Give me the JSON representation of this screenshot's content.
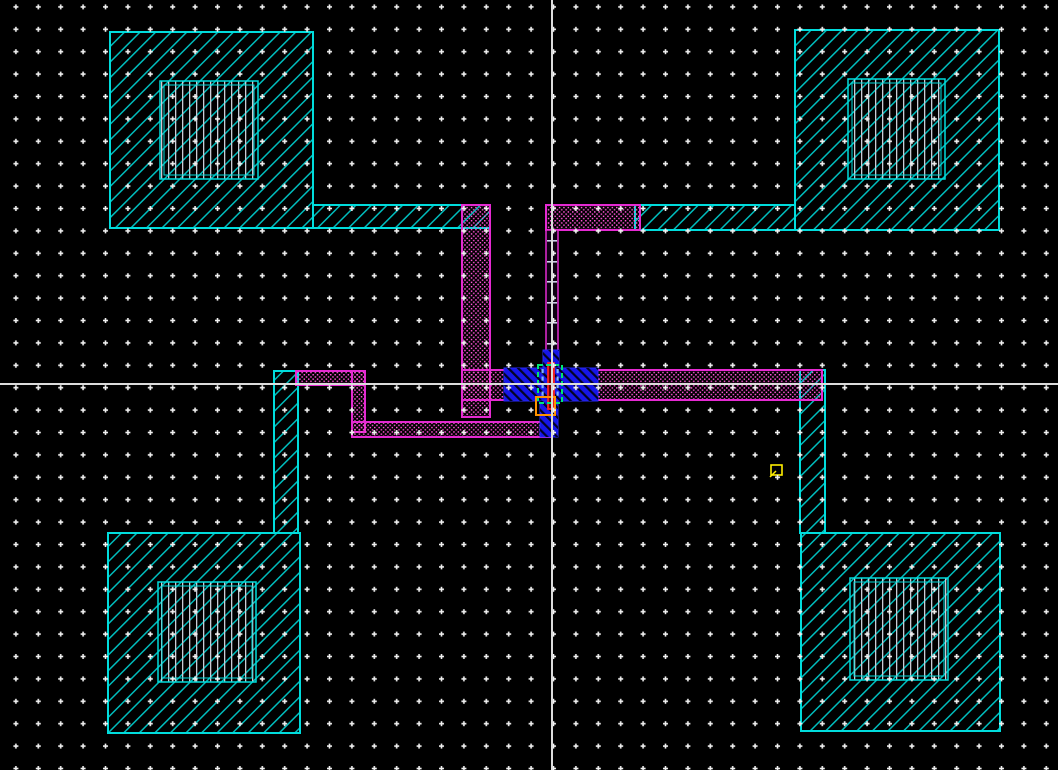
{
  "canvas": {
    "width": 1058,
    "height": 770,
    "background": "#000000"
  },
  "grid": {
    "spacing": 22.4,
    "offset_x": 16,
    "offset_y": 7,
    "dot_style": "plus",
    "dot_color": "#f2f2f2"
  },
  "crosshair": {
    "x": 551,
    "y": 383,
    "color": "#dcdcdc"
  },
  "palette": {
    "pad_cyan": "#00dcdc",
    "metal_magenta": "#e52ad2",
    "metal_stipple_pink": "#ff54d8",
    "device_blue": "#1616e8",
    "gate_red": "#ff2222",
    "select_green": "#00e673",
    "marker_orange": "#ff9100",
    "instance_yellow": "#ffee00",
    "opening_gray": "#c9ccd6"
  },
  "shapes": [
    {
      "type": "rect",
      "name": "canvas-background",
      "x": 0,
      "y": 0,
      "w": 1058,
      "h": 770,
      "fill": "#000000"
    },
    {
      "type": "rect",
      "name": "pad-top-left",
      "x": 110,
      "y": 32,
      "w": 203,
      "h": 196,
      "fill": "p:hatchCyan",
      "stroke": "#00dcdc",
      "sw": 2
    },
    {
      "type": "rect",
      "name": "pad-top-left-arm",
      "x": 313,
      "y": 205,
      "w": 177,
      "h": 23,
      "fill": "p:hatchCyan",
      "stroke": "#00dcdc",
      "sw": 2
    },
    {
      "type": "rect",
      "name": "pad-top-right",
      "x": 795,
      "y": 30,
      "w": 204,
      "h": 200,
      "fill": "p:hatchCyan",
      "stroke": "#00dcdc",
      "sw": 2
    },
    {
      "type": "rect",
      "name": "pad-top-right-arm",
      "x": 635,
      "y": 205,
      "w": 160,
      "h": 25,
      "fill": "p:hatchCyan",
      "stroke": "#00dcdc",
      "sw": 2
    },
    {
      "type": "rect",
      "name": "pad-bottom-left",
      "x": 108,
      "y": 533,
      "w": 192,
      "h": 200,
      "fill": "p:hatchCyan",
      "stroke": "#00dcdc",
      "sw": 2
    },
    {
      "type": "rect",
      "name": "pad-bottom-left-arm",
      "x": 274,
      "y": 371,
      "w": 24,
      "h": 162,
      "fill": "p:hatchCyan",
      "stroke": "#00dcdc",
      "sw": 2
    },
    {
      "type": "rect",
      "name": "pad-bottom-right",
      "x": 801,
      "y": 533,
      "w": 199,
      "h": 198,
      "fill": "p:hatchCyan",
      "stroke": "#00dcdc",
      "sw": 2
    },
    {
      "type": "rect",
      "name": "pad-bottom-right-arm",
      "x": 800,
      "y": 370,
      "w": 25,
      "h": 163,
      "fill": "p:hatchCyan",
      "stroke": "#00dcdc",
      "sw": 2
    },
    {
      "type": "rect",
      "name": "pad-opening-top-left",
      "x": 160,
      "y": 81,
      "w": 98,
      "h": 98,
      "fill": "p:vertLines",
      "stroke": "#00dcdc",
      "sw": 1.5
    },
    {
      "type": "rect",
      "name": "pad-opening-top-left-inner",
      "x": 164,
      "y": 85,
      "w": 90,
      "h": 90,
      "fill": "none",
      "stroke": "#00dcdc",
      "sw": 1
    },
    {
      "type": "rect",
      "name": "pad-opening-top-right",
      "x": 848,
      "y": 79,
      "w": 97,
      "h": 100,
      "fill": "p:vertLines",
      "stroke": "#00dcdc",
      "sw": 1.5
    },
    {
      "type": "rect",
      "name": "pad-opening-top-right-inner",
      "x": 852,
      "y": 83,
      "w": 89,
      "h": 92,
      "fill": "none",
      "stroke": "#00dcdc",
      "sw": 1
    },
    {
      "type": "rect",
      "name": "pad-opening-bottom-left",
      "x": 158,
      "y": 582,
      "w": 98,
      "h": 100,
      "fill": "p:vertLines",
      "stroke": "#00dcdc",
      "sw": 1.5
    },
    {
      "type": "rect",
      "name": "pad-opening-bottom-left-inner",
      "x": 162,
      "y": 586,
      "w": 90,
      "h": 92,
      "fill": "none",
      "stroke": "#00dcdc",
      "sw": 1
    },
    {
      "type": "rect",
      "name": "pad-opening-bottom-right",
      "x": 850,
      "y": 578,
      "w": 98,
      "h": 102,
      "fill": "p:vertLines",
      "stroke": "#00dcdc",
      "sw": 1.5
    },
    {
      "type": "rect",
      "name": "pad-opening-bottom-right-inner",
      "x": 854,
      "y": 582,
      "w": 90,
      "h": 94,
      "fill": "none",
      "stroke": "#00dcdc",
      "sw": 1
    },
    {
      "type": "rect",
      "name": "metal-trace-left-vertical",
      "x": 462,
      "y": 205,
      "w": 28,
      "h": 212,
      "fill": "p:magDots",
      "stroke": "#e52ad2",
      "sw": 2
    },
    {
      "type": "rect",
      "name": "metal-trace-left-link",
      "x": 462,
      "y": 370,
      "w": 44,
      "h": 30,
      "fill": "p:magDots",
      "stroke": "#e52ad2",
      "sw": 2
    },
    {
      "type": "rect",
      "name": "metal-trace-top-horizontal",
      "x": 546,
      "y": 205,
      "w": 94,
      "h": 25,
      "fill": "p:magDots",
      "stroke": "#e52ad2",
      "sw": 2
    },
    {
      "type": "rect",
      "name": "metal-trace-right-horizontal",
      "x": 592,
      "y": 370,
      "w": 230,
      "h": 30,
      "fill": "p:magDots",
      "stroke": "#e52ad2",
      "sw": 2
    },
    {
      "type": "rect",
      "name": "metal-trace-lower-left-h1",
      "x": 296,
      "y": 371,
      "w": 69,
      "h": 14,
      "fill": "p:magDots",
      "stroke": "#e52ad2",
      "sw": 2
    },
    {
      "type": "rect",
      "name": "metal-trace-lower-left-v",
      "x": 352,
      "y": 371,
      "w": 13,
      "h": 61,
      "fill": "p:magDots",
      "stroke": "#e52ad2",
      "sw": 2
    },
    {
      "type": "rect",
      "name": "metal-trace-lower-left-h2",
      "x": 352,
      "y": 422,
      "w": 198,
      "h": 15,
      "fill": "p:magDots",
      "stroke": "#e52ad2",
      "sw": 2
    },
    {
      "type": "rect",
      "name": "metal-trace-center-ladder",
      "x": 546,
      "y": 230,
      "w": 12,
      "h": 138,
      "fill": "#0d0011",
      "stroke": "#e52ad2",
      "sw": 1.5
    },
    {
      "type": "rect",
      "name": "ladder-via-rung",
      "x": 547,
      "y": 240,
      "w": 10,
      "h": 1.6,
      "fill": "#ccd0e8"
    },
    {
      "type": "rect",
      "name": "ladder-via-rung",
      "x": 547,
      "y": 261,
      "w": 10,
      "h": 1.6,
      "fill": "#ccd0e8"
    },
    {
      "type": "rect",
      "name": "ladder-via-rung",
      "x": 547,
      "y": 281,
      "w": 10,
      "h": 1.6,
      "fill": "#ccd0e8"
    },
    {
      "type": "rect",
      "name": "ladder-via-rung",
      "x": 547,
      "y": 302,
      "w": 10,
      "h": 1.6,
      "fill": "#ccd0e8"
    },
    {
      "type": "rect",
      "name": "ladder-via-rung",
      "x": 547,
      "y": 322,
      "w": 10,
      "h": 1.6,
      "fill": "#ccd0e8"
    },
    {
      "type": "rect",
      "name": "ladder-via-rung",
      "x": 547,
      "y": 343,
      "w": 10,
      "h": 1.6,
      "fill": "#ccd0e8"
    },
    {
      "type": "rect",
      "name": "ladder-via-rung",
      "x": 547,
      "y": 363,
      "w": 10,
      "h": 1.6,
      "fill": "#ccd0e8"
    },
    {
      "type": "rect",
      "name": "device-blue-stub-top",
      "x": 543,
      "y": 350,
      "w": 16,
      "h": 20,
      "fill": "#1616e8",
      "overlay": "p:blueStripes",
      "stroke": "#2a2af5",
      "sw": 1
    },
    {
      "type": "rect",
      "name": "device-blue-bar",
      "x": 504,
      "y": 368,
      "w": 94,
      "h": 33,
      "fill": "#1616e8",
      "overlay": "p:blueStripes",
      "stroke": "#2a2af5",
      "sw": 1
    },
    {
      "type": "rect",
      "name": "device-blue-stub-bottom",
      "x": 540,
      "y": 401,
      "w": 18,
      "h": 36,
      "fill": "#1616e8",
      "overlay": "p:blueStripes",
      "stroke": "#2a2af5",
      "sw": 1
    },
    {
      "type": "rect",
      "name": "contact-dash",
      "x": 541.5,
      "y": 369,
      "w": 2.2,
      "h": 4.2,
      "fill": "#7fb2ff"
    },
    {
      "type": "rect",
      "name": "contact-dash",
      "x": 541.5,
      "y": 376.5,
      "w": 2.2,
      "h": 4.2,
      "fill": "#7fb2ff"
    },
    {
      "type": "rect",
      "name": "contact-dash",
      "x": 541.5,
      "y": 384,
      "w": 2.2,
      "h": 4.2,
      "fill": "#7fb2ff"
    },
    {
      "type": "rect",
      "name": "contact-dash",
      "x": 541.5,
      "y": 391.5,
      "w": 2.2,
      "h": 4.2,
      "fill": "#7fb2ff"
    },
    {
      "type": "rect",
      "name": "contact-dash",
      "x": 556.5,
      "y": 369,
      "w": 2.2,
      "h": 4.2,
      "fill": "#7fb2ff"
    },
    {
      "type": "rect",
      "name": "contact-dash",
      "x": 556.5,
      "y": 376.5,
      "w": 2.2,
      "h": 4.2,
      "fill": "#7fb2ff"
    },
    {
      "type": "rect",
      "name": "contact-dash",
      "x": 556.5,
      "y": 384,
      "w": 2.2,
      "h": 4.2,
      "fill": "#7fb2ff"
    },
    {
      "type": "rect",
      "name": "contact-dash",
      "x": 556.5,
      "y": 391.5,
      "w": 2.2,
      "h": 4.2,
      "fill": "#7fb2ff"
    },
    {
      "type": "rect",
      "name": "gate-red-bar",
      "x": 548,
      "y": 363,
      "w": 6,
      "h": 46,
      "fill": "#6e0505",
      "stroke": "#ff2222",
      "sw": 1.8
    },
    {
      "type": "rect",
      "name": "select-green-box",
      "x": 538,
      "y": 365,
      "w": 24,
      "h": 38,
      "fill": "none",
      "stroke": "#00e673",
      "sw": 2,
      "dash": "5,3"
    },
    {
      "type": "rect",
      "name": "marker-orange-box",
      "x": 536,
      "y": 397,
      "w": 19,
      "h": 18,
      "fill": "none",
      "stroke": "#ff9100",
      "sw": 2
    },
    {
      "type": "rect",
      "name": "instance-marker-yellow",
      "x": 771,
      "y": 465,
      "w": 11,
      "h": 10,
      "fill": "none",
      "stroke": "#ffee00",
      "sw": 1.6
    },
    {
      "type": "line",
      "name": "instance-marker-yellow-tick",
      "x1": 776,
      "y1": 471,
      "x2": 770,
      "y2": 477,
      "stroke": "#ffee00",
      "sw": 1.5
    },
    {
      "type": "rect",
      "name": "grid-dot-overlay",
      "x": 0,
      "y": 0,
      "w": 1058,
      "h": 770,
      "fill": "p:gridPlus"
    },
    {
      "type": "rect",
      "name": "crosshair-vertical-line",
      "x": 551,
      "y": 0,
      "w": 2,
      "h": 770,
      "fill": "#dcdcdc"
    },
    {
      "type": "rect",
      "name": "crosshair-horizontal-line",
      "x": 0,
      "y": 383,
      "w": 1058,
      "h": 2,
      "fill": "#dcdcdc"
    }
  ]
}
